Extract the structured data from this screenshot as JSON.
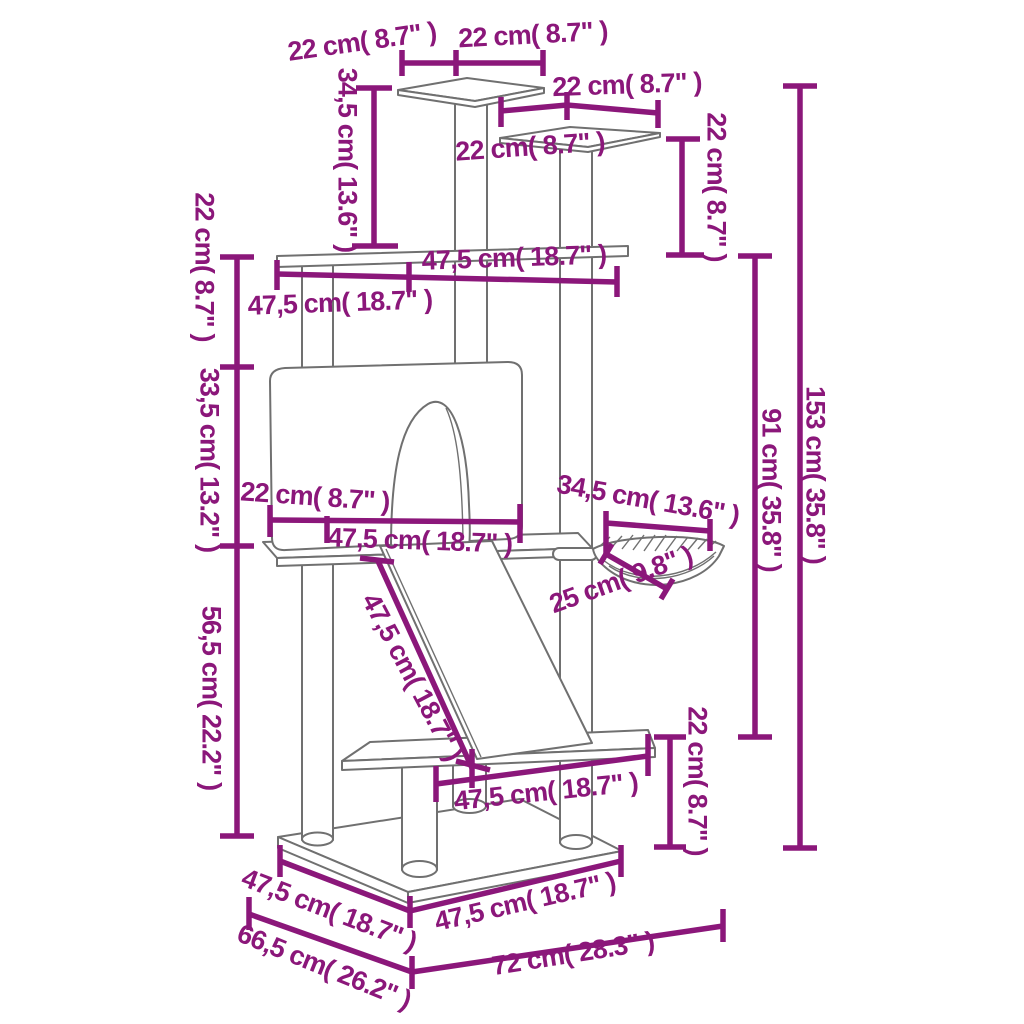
{
  "diagram": {
    "product": "cat tree with scratching posts - dimension drawing",
    "colors": {
      "dimension_accent": "#8B177A",
      "structure_outline": "#707070",
      "background": "#FFFFFF"
    },
    "labels": [
      {
        "id": "top-platform-depth",
        "text": "22 cm( 8.7\" )"
      },
      {
        "id": "top-platform-width",
        "text": "22 cm( 8.7\" )"
      },
      {
        "id": "perch2-width",
        "text": "22 cm( 8.7\" )"
      },
      {
        "id": "perch2-depth",
        "text": "22 cm( 8.7\" )"
      },
      {
        "id": "perch2-post-height",
        "text": "22 cm( 8.7\" )"
      },
      {
        "id": "top-post-height",
        "text": "34,5 cm( 13.6\" )"
      },
      {
        "id": "upper-gap-height",
        "text": "22 cm( 8.7\" )"
      },
      {
        "id": "house-height",
        "text": "33,5 cm( 13.2\" )"
      },
      {
        "id": "lower-section-height",
        "text": "56,5 cm( 22.2\" )"
      },
      {
        "id": "upper-platform-depth",
        "text": "47,5 cm( 18.7\" )"
      },
      {
        "id": "upper-platform-width",
        "text": "47,5 cm( 18.7\" )"
      },
      {
        "id": "house-depth",
        "text": "22 cm( 8.7\" )"
      },
      {
        "id": "house-width",
        "text": "47,5 cm( 18.7\" )"
      },
      {
        "id": "basket-width",
        "text": "34,5 cm( 13.6\" )"
      },
      {
        "id": "basket-depth",
        "text": "25 cm( 9.8\" )"
      },
      {
        "id": "ramp-length",
        "text": "47,5 cm( 18.7\" )"
      },
      {
        "id": "mid-height",
        "text": "91 cm( 35.8\" )"
      },
      {
        "id": "total-height",
        "text": "153 cm( 35.8\" )"
      },
      {
        "id": "plinth-height",
        "text": "22 cm( 8.7\" )"
      },
      {
        "id": "mid-platform-width",
        "text": "47,5 cm( 18.7\" )"
      },
      {
        "id": "base-depth",
        "text": "47,5 cm( 18.7\" )"
      },
      {
        "id": "base-depth-overall",
        "text": "66,5 cm( 26.2\" )"
      },
      {
        "id": "base-width",
        "text": "47,5 cm( 18.7\" )"
      },
      {
        "id": "base-width-overall",
        "text": "72 cm( 28.3\" )"
      }
    ]
  }
}
